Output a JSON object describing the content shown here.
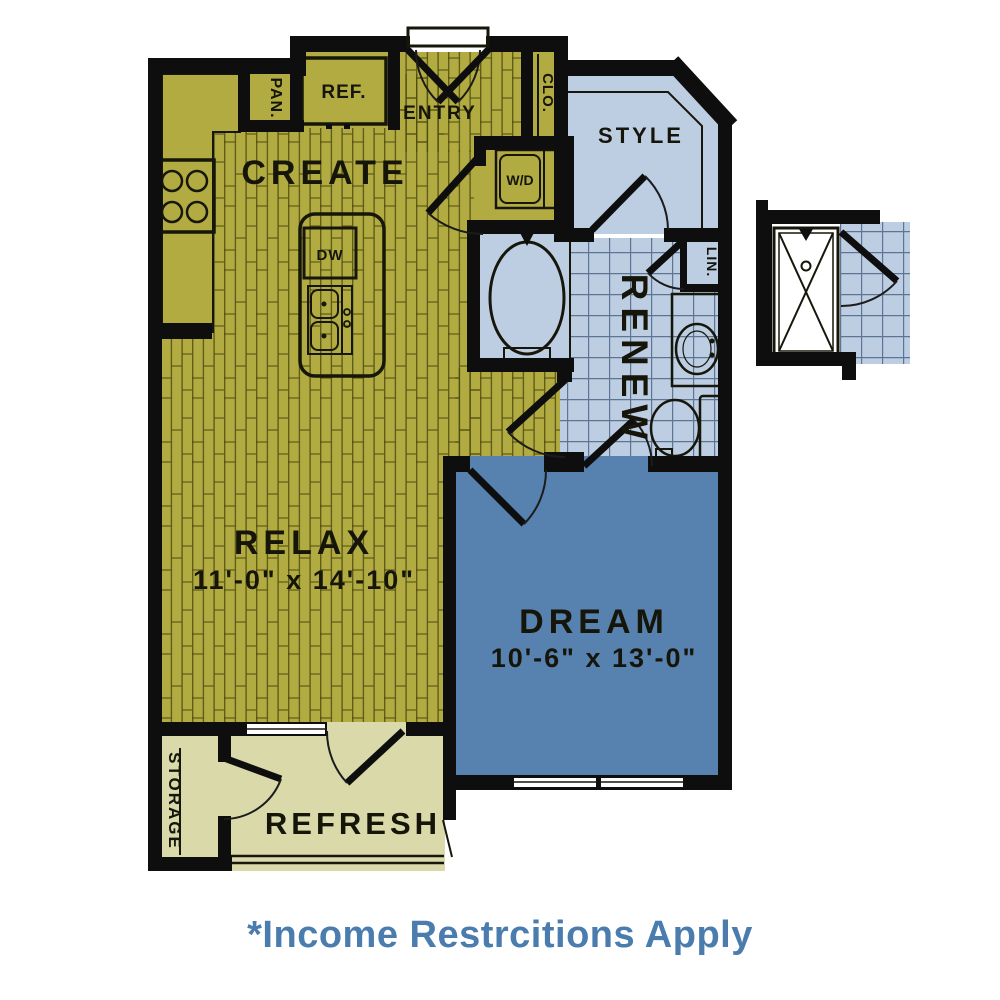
{
  "page": {
    "caption": "*Income Restrcitions Apply"
  },
  "colors": {
    "olive": "#b1ab42",
    "light_blue": "#bdcee3",
    "dream_blue": "#5781ae",
    "tan": "#d9d9aa",
    "shower_pan": "#dce6f1",
    "wall": "#0e0e0e",
    "caption_blue": "#4a7cae"
  },
  "rooms": {
    "create": {
      "label": "CREATE"
    },
    "relax": {
      "label": "RELAX",
      "dimensions": "11'-0\" x 14'-10\""
    },
    "dream": {
      "label": "DREAM",
      "dimensions": "10'-6\" x 13'-0\""
    },
    "renew": {
      "label": "RENEW"
    },
    "style": {
      "label": "STYLE"
    },
    "refresh": {
      "label": "REFRESH"
    },
    "entry": {
      "label": "ENTRY"
    },
    "storage": {
      "label": "STORAGE"
    }
  },
  "fixtures": {
    "pantry": {
      "label": "PAN."
    },
    "refrigerator": {
      "label": "REF."
    },
    "coat_closet": {
      "label": "CLO."
    },
    "washer_dryer": {
      "label": "W/D"
    },
    "dishwasher": {
      "label": "DW"
    },
    "linen": {
      "label": "LIN."
    }
  }
}
